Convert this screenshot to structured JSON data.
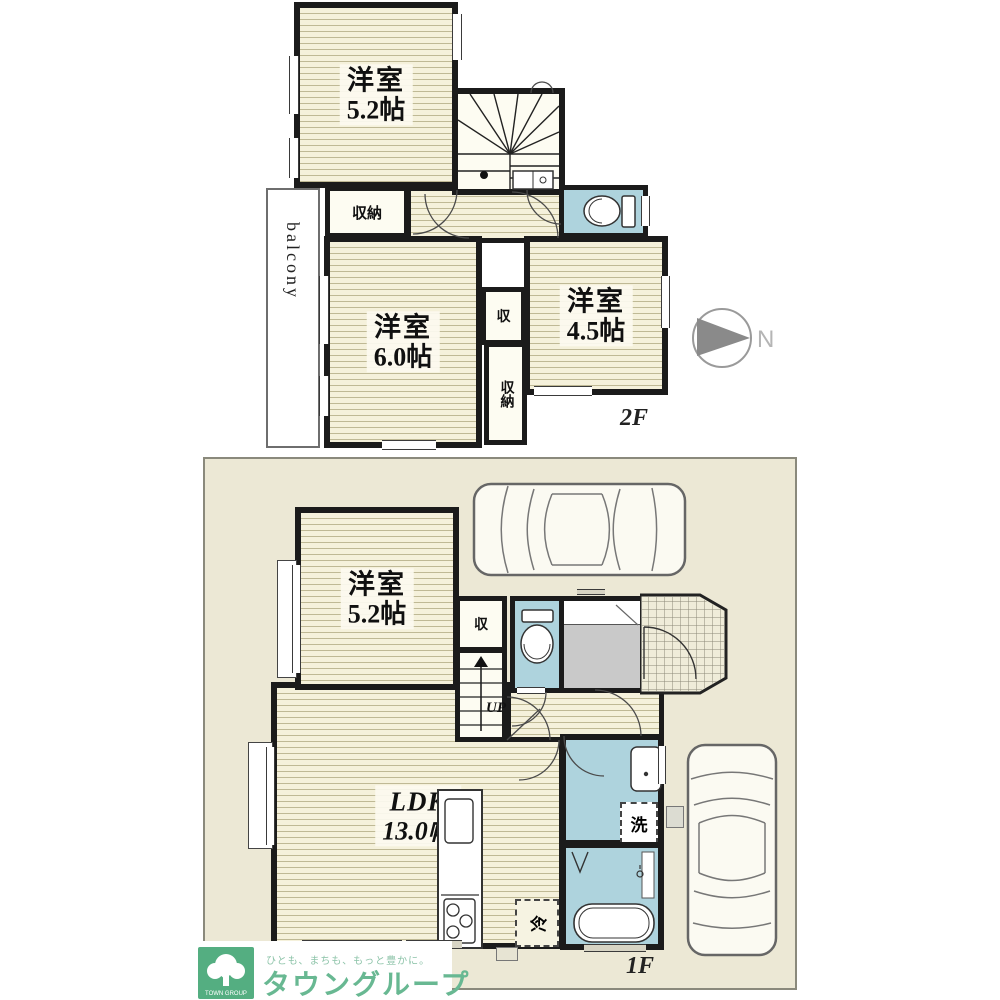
{
  "floor2": {
    "label": "2F",
    "room_a": {
      "name": "洋室",
      "size": "5.2帖"
    },
    "room_b": {
      "name": "洋室",
      "size": "6.0帖"
    },
    "room_c": {
      "name": "洋室",
      "size": "4.5帖"
    },
    "closet_a": {
      "label": "収納"
    },
    "closet_b": {
      "label": "収"
    },
    "closet_c": {
      "label": "収納"
    },
    "balcony": {
      "label": "balcony"
    }
  },
  "floor1": {
    "label": "1F",
    "room_a": {
      "name": "洋室",
      "size": "5.2帖"
    },
    "ldk": {
      "name": "LDK",
      "size": "13.0帖"
    },
    "closet": {
      "label": "収"
    },
    "stairs": {
      "label": "UP"
    },
    "laundry": {
      "label": "洗"
    },
    "fridge": {
      "label": "冷"
    }
  },
  "compass": {
    "north_label": "N"
  },
  "branding": {
    "logo_caption": "TOWN GROUP",
    "slogan": "ひとも、まちも、もっと豊かに。",
    "company_name": "タウングループ"
  },
  "colors": {
    "wall": "#1b1b1b",
    "floor_stripe_base": "#f5f1db",
    "floor_stripe_line": "#bfb995",
    "wet_area": "#aed3dd",
    "lot_background": "#ece8d5",
    "entrance_gray": "#c9c9c9",
    "brand_green": "#54ae81",
    "brand_text_green": "#68b892"
  }
}
